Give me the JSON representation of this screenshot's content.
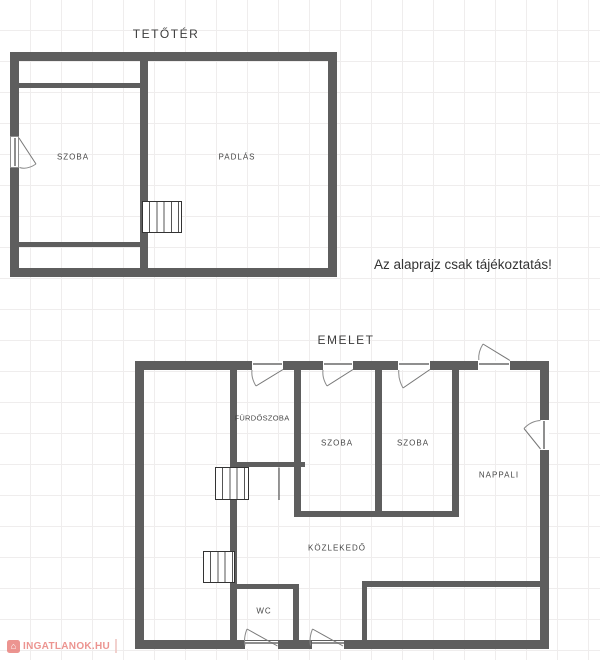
{
  "colors": {
    "wall": "#5e5e5e",
    "title": "#3d3d3d",
    "label": "#474747",
    "grid": "#efeded",
    "watermark": "#e9827d"
  },
  "attic_plan": {
    "title": "TETŐTÉR",
    "rooms": [
      {
        "label": "SZOBA"
      },
      {
        "label": "PADLÁS"
      }
    ]
  },
  "floor_plan": {
    "title": "EMELET",
    "rooms": [
      {
        "label": "FÜRDŐSZOBA"
      },
      {
        "label": "SZOBA"
      },
      {
        "label": "SZOBA"
      },
      {
        "label": "NAPPALI"
      },
      {
        "label": "KÖZLEKEDŐ"
      },
      {
        "label": "WC"
      }
    ]
  },
  "disclaimer": "Az alaprajz csak tájékoztatás!",
  "watermark": {
    "icon": "house-icon",
    "icon_glyph": "⌂",
    "text": "INGATLANOK.HU"
  }
}
